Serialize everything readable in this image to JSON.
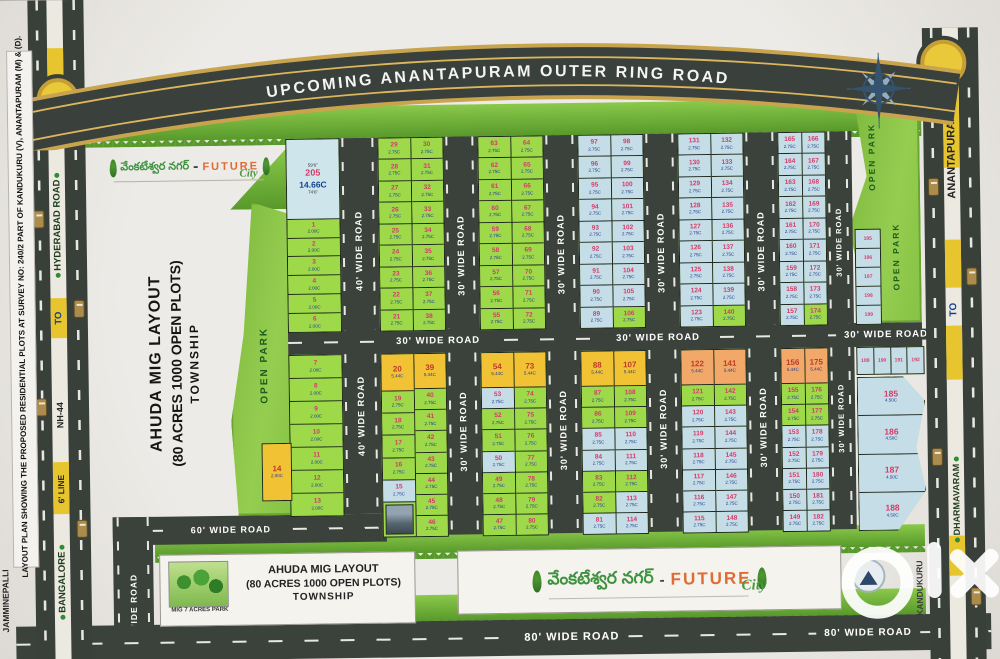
{
  "ring_road_label": "UPCOMING  ANANTAPURAM OUTER RING ROAD",
  "survey_note": "LAYOUT PLAN SHOWING THE PROPOSED RESIDENTIAL PLOTS AT SURVEY NO: 240/2 PART OF KANDUKURU (V), ANANTAPURAM (M) & (D).",
  "village": "JAMMINEPALLI",
  "left_road": {
    "hyderabad": "HYDERABAD ROAD",
    "to": "TO",
    "nh44": "NH-44",
    "line6": "6' LINE",
    "bangalore": "BANGALORE"
  },
  "right_road": {
    "anantapuram": "ANANTAPURAM",
    "to": "TO",
    "dharmavaram": "DHARMAVARAM",
    "kandukuru": "KANDUKURU"
  },
  "roads": {
    "w40": "40' WIDE ROAD",
    "w30": "30' WIDE ROAD",
    "w60": "60' WIDE ROAD",
    "w80": "80' WIDE ROAD"
  },
  "title_block": {
    "line1": "AHUDA MIG LAYOUT",
    "line2": "(80 ACRES 1000 OPEN PLOTS)",
    "line3": "TOWNSHIP"
  },
  "brand": {
    "telugu": "వేంకటేశ్వర నగర్",
    "dash": "-",
    "future": "FUTURE",
    "city": "City"
  },
  "park": {
    "open": "OPEN PARK",
    "mig": "MIG 7 ACRES PARK"
  },
  "watermark": {
    "brand": "olx"
  },
  "colors": {
    "plot_green": "#9ed94a",
    "plot_blue": "#c5dde7",
    "plot_yellow": "#f2c235",
    "plot_orange": "#f1a868",
    "road_dark": "#3b423c",
    "ring_gold": "#c9a44e",
    "park_green": "#8cc63f",
    "number_pink": "#d63a6a",
    "size_blue": "#1b3a8c"
  },
  "special_plot": {
    "n": "205",
    "size": "14.66C",
    "top_dim": "59'6\"",
    "bottom_dim": "74'6\""
  },
  "plot_zones": [
    {
      "y": 142,
      "h": 192,
      "blocks": [
        {
          "x": 296,
          "w": 52,
          "t": "g",
          "s": "2.00C",
          "name": "strip-block-upper",
          "cols": [
            [
              {
                "n": "205",
                "s": "14.66C",
                "c": "bb",
                "f": 4.4,
                "dt": "59'6\"",
                "db": "74'6\""
              },
              "1",
              "2",
              "3",
              "4",
              "5",
              "6"
            ]
          ]
        },
        {
          "x": 388,
          "w": 64,
          "t": "g",
          "s": "2.75C",
          "name": "block-21-38",
          "cols": [
            [
              "29",
              "28",
              "27",
              "26",
              "25",
              "24",
              "23",
              "22",
              "21"
            ],
            [
              "30",
              "31",
              "32",
              "33",
              "34",
              "35",
              "36",
              "37",
              "38"
            ]
          ]
        },
        {
          "x": 488,
          "w": 64,
          "t": "g",
          "s": "2.75C",
          "name": "block-55-72",
          "cols": [
            [
              "63",
              "62",
              "61",
              "60",
              "59",
              "58",
              "57",
              "56",
              "55"
            ],
            [
              "64",
              "65",
              "66",
              "67",
              "68",
              "69",
              "70",
              "71",
              "72"
            ]
          ]
        },
        {
          "x": 588,
          "w": 64,
          "t": "b",
          "s": "2.75C",
          "name": "block-89-106",
          "cols": [
            [
              "97",
              "96",
              "95",
              "94",
              "93",
              "92",
              "91",
              "90",
              "89"
            ],
            [
              "98",
              "99",
              "100",
              "101",
              "102",
              "103",
              "104",
              "105",
              {
                "n": "106",
                "c": "g"
              }
            ]
          ]
        },
        {
          "x": 688,
          "w": 64,
          "t": "b",
          "s": "2.75C",
          "name": "block-123-140",
          "cols": [
            [
              "131",
              "130",
              "129",
              "128",
              "127",
              "126",
              "125",
              "124",
              "123"
            ],
            [
              "132",
              "133",
              "134",
              "135",
              "136",
              "137",
              "138",
              "139",
              {
                "n": "140",
                "c": "g"
              }
            ]
          ]
        },
        {
          "x": 788,
          "w": 46,
          "t": "b",
          "s": "2.75C",
          "name": "block-157-174",
          "cols": [
            [
              "165",
              "164",
              "163",
              "162",
              "161",
              "160",
              "159",
              "158",
              "157"
            ],
            [
              "166",
              "167",
              "168",
              "169",
              "170",
              "171",
              "172",
              "173",
              {
                "n": "174",
                "c": "g"
              }
            ]
          ]
        },
        {
          "x": 864,
          "w": 24,
          "y": 240,
          "h": 94,
          "t": "b",
          "s": "",
          "cls": "tiny",
          "name": "park-side-column",
          "cols": [
            [
              "195",
              "196",
              "197",
              "198",
              "199"
            ]
          ]
        }
      ]
    },
    {
      "y": 358,
      "h": 182,
      "blocks": [
        {
          "x": 296,
          "w": 52,
          "h": 160,
          "t": "g",
          "s": "2.00C",
          "name": "strip-block-lower",
          "cols": [
            [
              "7",
              "8",
              "9",
              "10",
              "11",
              "12",
              "13"
            ]
          ]
        },
        {
          "x": 268,
          "w": 28,
          "y": 446,
          "h": 56,
          "t": "y",
          "s": "2.00C",
          "name": "plot-14-block",
          "cols": [
            [
              {
                "n": "14",
                "c": "y"
              }
            ]
          ]
        },
        {
          "x": 388,
          "w": 64,
          "t": "g",
          "s": "2.75C",
          "name": "block-15-46",
          "cols": [
            [
              {
                "n": "20",
                "s": "5.44C",
                "c": "y",
                "f": 1.7
              },
              "19",
              "18",
              "17",
              "16",
              {
                "n": "15",
                "c": "b"
              },
              {
                "c": "img",
                "f": 1.6
              }
            ],
            [
              {
                "n": "39",
                "s": "5.44C",
                "c": "y",
                "f": 1.7
              },
              "40",
              "41",
              "42",
              "43",
              "44",
              "45",
              "46"
            ]
          ]
        },
        {
          "x": 488,
          "w": 64,
          "t": "g",
          "s": "2.75C",
          "name": "block-47-80",
          "cols": [
            [
              {
                "n": "54",
                "s": "5.44C",
                "c": "y",
                "f": 1.7
              },
              {
                "n": "53",
                "c": "b"
              },
              "52",
              "51",
              {
                "n": "50",
                "c": "b"
              },
              "49",
              "48",
              "47"
            ],
            [
              {
                "n": "73",
                "s": "5.44C",
                "c": "y",
                "f": 1.7
              },
              "74",
              "75",
              "76",
              "77",
              "78",
              "79",
              "80"
            ]
          ]
        },
        {
          "x": 588,
          "w": 64,
          "t": "g",
          "s": "2.75C",
          "name": "block-81-114",
          "cols": [
            [
              {
                "n": "88",
                "s": "5.44C",
                "c": "y",
                "f": 1.7
              },
              "87",
              "86",
              {
                "n": "85",
                "c": "b"
              },
              {
                "n": "84",
                "c": "b"
              },
              "83",
              "82",
              {
                "n": "81",
                "c": "b"
              }
            ],
            [
              {
                "n": "107",
                "s": "5.44C",
                "c": "y",
                "f": 1.7
              },
              "108",
              "109",
              {
                "n": "110",
                "c": "b"
              },
              {
                "n": "111",
                "c": "b"
              },
              "112",
              {
                "n": "113",
                "c": "b"
              },
              {
                "n": "114",
                "c": "b"
              }
            ]
          ]
        },
        {
          "x": 688,
          "w": 64,
          "t": "b",
          "s": "2.75C",
          "name": "block-115-148",
          "cols": [
            [
              {
                "n": "122",
                "s": "5.44C",
                "c": "o",
                "f": 1.7
              },
              {
                "n": "121",
                "c": "g"
              },
              "120",
              "119",
              "118",
              "117",
              "116",
              "115"
            ],
            [
              {
                "n": "141",
                "s": "5.44C",
                "c": "o",
                "f": 1.7
              },
              {
                "n": "142",
                "c": "g"
              },
              "143",
              "144",
              "145",
              "146",
              "147",
              "148"
            ]
          ]
        },
        {
          "x": 788,
          "w": 46,
          "t": "b",
          "s": "2.75C",
          "name": "block-149-182",
          "cols": [
            [
              {
                "n": "156",
                "s": "5.44C",
                "c": "o",
                "f": 1.7
              },
              {
                "n": "155",
                "c": "g"
              },
              {
                "n": "154",
                "c": "g"
              },
              "153",
              "152",
              "151",
              "150",
              "149"
            ],
            [
              {
                "n": "175",
                "s": "5.44C",
                "c": "o",
                "f": 1.7
              },
              {
                "n": "176",
                "c": "g"
              },
              {
                "n": "177",
                "c": "g"
              },
              "178",
              "179",
              "180",
              "181",
              "182"
            ]
          ]
        },
        {
          "x": 864,
          "w": 66,
          "h": 26,
          "t": "b",
          "s": "",
          "cls": "tiny",
          "name": "wedge-top-row",
          "cols": [
            [
              "189"
            ],
            [
              "190"
            ],
            [
              "191"
            ],
            [
              "192"
            ]
          ]
        },
        {
          "x": 864,
          "w": 66,
          "y": 388,
          "h": 152,
          "t": "b",
          "s": "4.50C",
          "cls": "wedge",
          "name": "wedge-plots-185-188",
          "clip": "polygon(0 0,68% 0,100% 16%,86% 46%,100% 74%,58% 100%,0 100%)",
          "cols": [
            [
              "185",
              "186",
              "187",
              "188"
            ]
          ]
        }
      ]
    }
  ]
}
